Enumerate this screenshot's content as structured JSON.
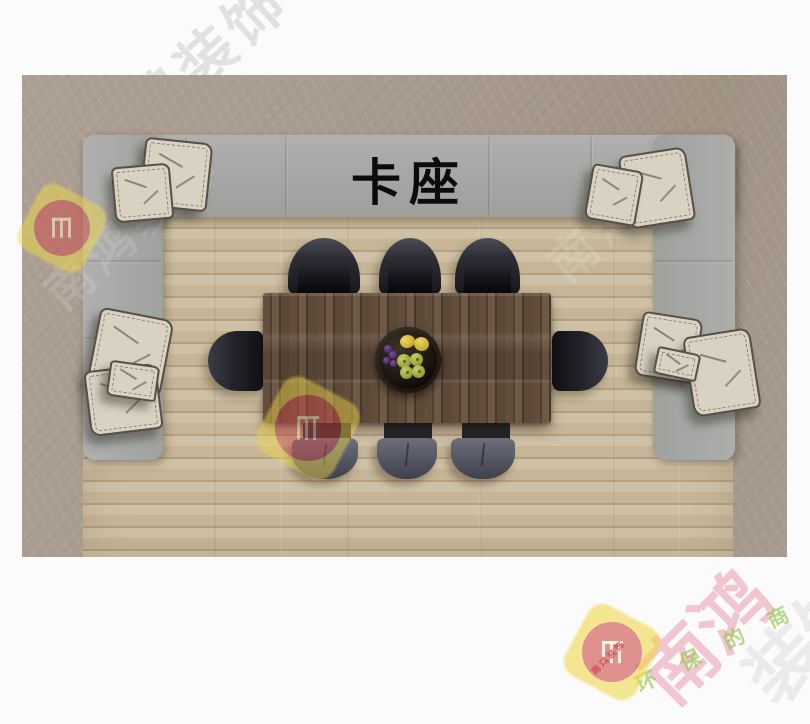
{
  "scene": {
    "booth_label": "卡座",
    "pillow_count": 10,
    "chair_count": 8,
    "fruits": [
      "lemon",
      "lemon",
      "grapes",
      "pear",
      "pear",
      "pear",
      "pear"
    ]
  },
  "colors": {
    "bench_gray": "#a7a8a6",
    "wood_floor": "#c6b697",
    "carpet_border": "#a89b8f",
    "table_walnut": "#5d4938",
    "chair_dark": "#23232a",
    "chair_seat_gray": "#535662",
    "pillow_beige": "#d9d1c1",
    "logo_yellow": "#f0d84a",
    "logo_red": "#ce4b48"
  },
  "watermark": {
    "corner_text": "南鸿装饰",
    "white_text": "南鸿装饰",
    "brand_text": "南鸿",
    "ghost_text": "装饰",
    "slogan_text": "环 保 的 商 品 质",
    "tiny_text": "南鸿装饰"
  }
}
